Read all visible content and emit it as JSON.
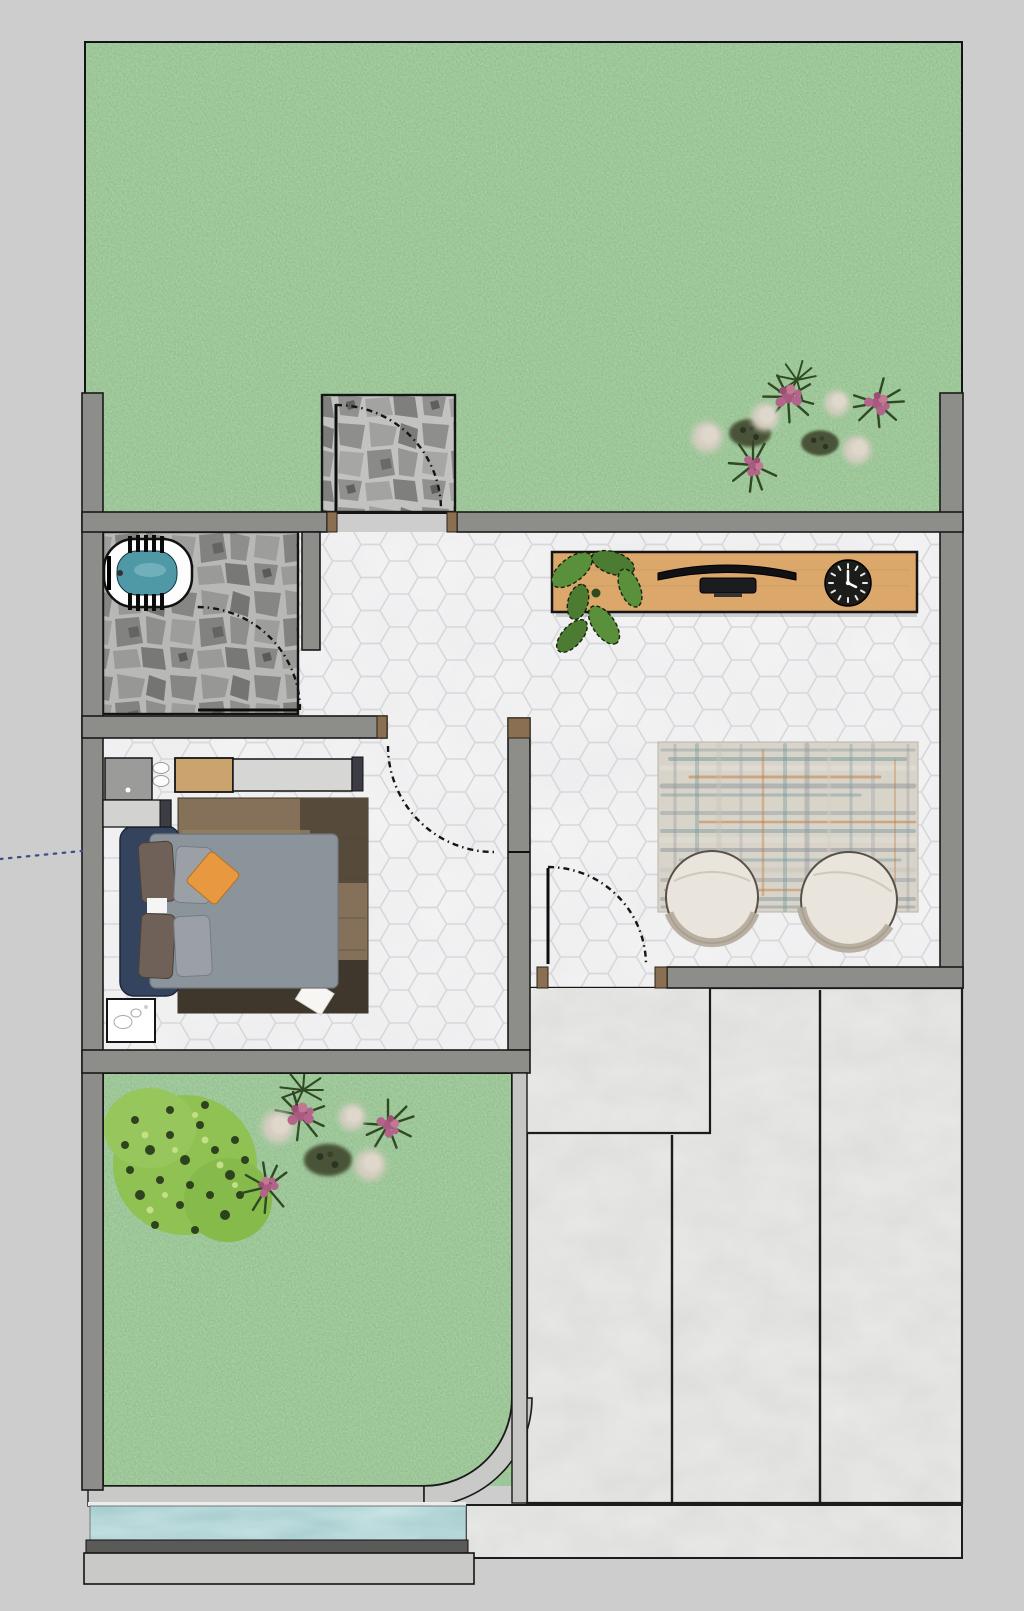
{
  "colors": {
    "background": "#cdcdce",
    "wall": "#8d8d89",
    "outline": "#1a1a1a",
    "jamb": "#8a6f52",
    "hex_tile": "#f4f4f5",
    "hex_line": "#d9d9db",
    "stone_grout": "#c2c2c0",
    "kerb": "#c6c6c4",
    "concrete": "#c8c8c6",
    "pool_water": "#78adb0",
    "pool_edge_dark": "#5a5a58",
    "deck": "#c9c9c7",
    "tub_white": "#fdfdfd",
    "tub_water": "#4f98a6",
    "desk_wood": "#dba76a",
    "tv_black": "#101114",
    "clock_black": "#1c1c1a",
    "plant_green": "#5a8f3b",
    "plant_green_dark": "#4c7c31",
    "bed_frame_navy": "#35445e",
    "duvet_gray": "#8b939b",
    "pillow_brown": "#6f6157",
    "pillow_gray": "#9aa0a6",
    "pillow_orange": "#e8993f",
    "bed_rug_wood": "#85705a",
    "chair_cream": "#e9e4dc",
    "chair_rim": "#b3a89a",
    "area_rug_base": "#d8d4ca",
    "rug_teal": "#6b9296",
    "rug_orange": "#c07a3a",
    "rug_gray": "#8f959b",
    "wardrobe_gray": "#d6d6d4",
    "wardrobe_wood": "#caa36f",
    "wardrobe_dark": "#3c3c44",
    "side_table_gray": "#9b9b99",
    "nightstand_white": "#ffffff",
    "bush_green": "#8fc153",
    "flower_pink": "#b4648a",
    "puff_white": "#d5cec1",
    "shrub_dark": "#4a5239",
    "grass_mid": "#5d9150",
    "measure_dotted": "#3c4d8f"
  },
  "elements": [
    "top-lawn",
    "lawn-flower-bed",
    "entry-stone-path",
    "entry-door",
    "foyer-hex-floor",
    "console-desk",
    "potted-plant",
    "flat-tv",
    "wall-clock",
    "bathroom",
    "bathtub",
    "bathroom-door",
    "bedroom",
    "bedroom-door",
    "wardrobe",
    "side-table",
    "double-bed",
    "bedroom-rug",
    "nightstand",
    "area-rug",
    "pod-chair-left",
    "pod-chair-right",
    "patio-door",
    "stone-porch",
    "driveway",
    "sidewalk",
    "garden",
    "garden-bush",
    "pool",
    "pool-deck",
    "measure-guide-line"
  ]
}
